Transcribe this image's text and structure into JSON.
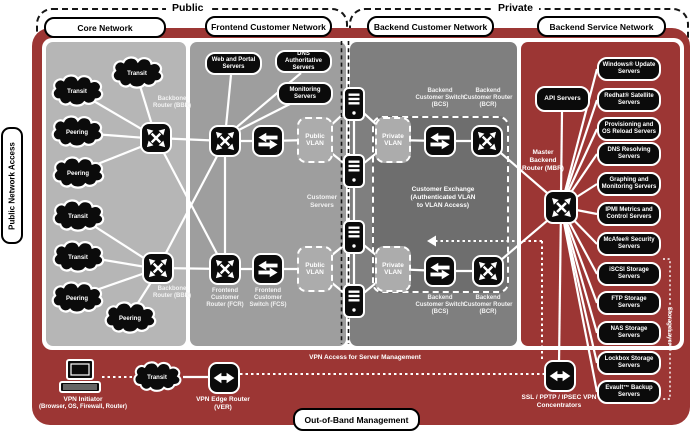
{
  "colors": {
    "red": "#9C3634",
    "panel_core": "#B6B6B6",
    "panel_frontend": "#9E9E9E",
    "panel_backend": "#7F7F7F",
    "exchange_fill": "#6E6E6E",
    "vlan_fill": "#ACACAC",
    "box_black": "#0B0B0B"
  },
  "zones": {
    "public": "Public",
    "private": "Private"
  },
  "headers": {
    "core": "Core Network",
    "frontend": "Frontend Customer Network",
    "backend_customer": "Backend Customer Network",
    "backend_service": "Backend Service Network",
    "oob": "Out-of-Band Management",
    "public_access": "Public Network Access"
  },
  "core": {
    "clouds": [
      "Transit",
      "Transit",
      "Peering",
      "Peering",
      "Transit",
      "Transit",
      "Peering",
      "Peering"
    ],
    "bbr": "Backbone Router (BBR)"
  },
  "frontend": {
    "web_portal": "Web and Portal Servers",
    "dns_auth": "DNS Authoritative Servers",
    "monitoring": "Monitoring Servers",
    "fcr": "Frontend Customer Router (FCR)",
    "fcs": "Frontend Customer Switch (FCS)",
    "public_vlan": "Public VLAN",
    "customer_servers": "Customer Servers"
  },
  "backend_customer": {
    "bcs": "Backend Customer Switch (BCS)",
    "bcr": "Backend Customer Router (BCR)",
    "private_vlan": "Private VLAN",
    "exchange_l1": "Customer Exchange",
    "exchange_l2": "(Authenticated VLAN",
    "exchange_l3": "to VLAN Access)"
  },
  "backend_service": {
    "api": "API Servers",
    "mbr": "Master Backend Router (MBR)",
    "storagelayer": "StorageLayer™",
    "servers": [
      "Windows® Update Servers",
      "Redhat® Satellite Servers",
      "Provisioning and OS Reload Servers",
      "DNS Resolving Servers",
      "Graphing and Monitoring Servers",
      "IPMI Metrics and Control Servers",
      "McAfee® Security Servers",
      "iSCSI Storage Servers",
      "FTP Storage Servers",
      "NAS Storage Servers",
      "Lockbox Storage Servers",
      "Evault™ Backup Servers"
    ]
  },
  "oob": {
    "vpn_initiator_l1": "VPN Initiator",
    "vpn_initiator_l2": "(Browser, OS, Firewall, Router)",
    "transit": "Transit",
    "ver": "VPN Edge Router (VER)",
    "vpn_access": "VPN Access for Server Management",
    "concentrators": "SSL / PPTP / IPSEC VPN Concentrators"
  }
}
